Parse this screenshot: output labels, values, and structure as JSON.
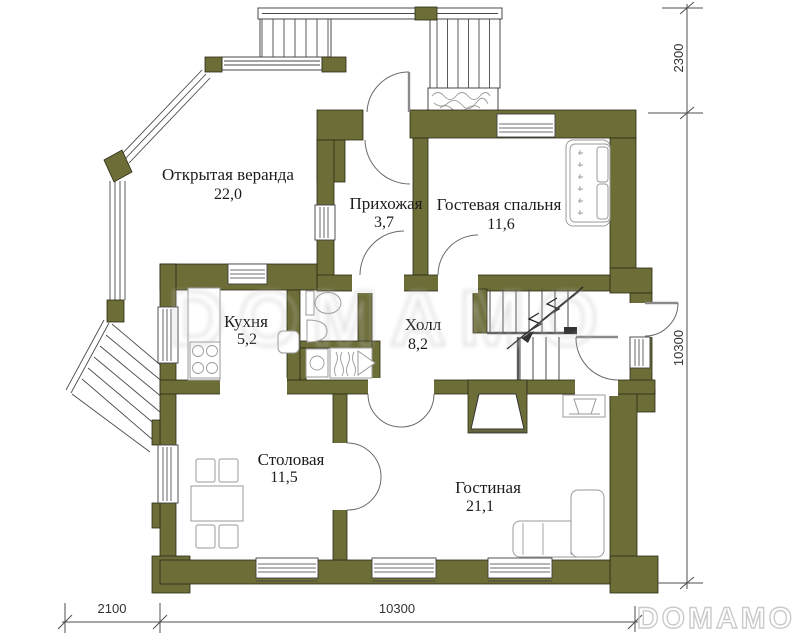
{
  "colors": {
    "wall": "#6d6d38",
    "outline": "#2b2b14",
    "furniture": "#9a9a9a",
    "watermark": "#bdbdbd"
  },
  "rooms": [
    {
      "name": "Открытая веранда",
      "area": "22,0"
    },
    {
      "name": "Прихожая",
      "area": "3,7"
    },
    {
      "name": "Гостевая спальня",
      "area": "11,6"
    },
    {
      "name": "Кухня",
      "area": "5,2"
    },
    {
      "name": "Холл",
      "area": "8,2"
    },
    {
      "name": "Столовая",
      "area": "11,5"
    },
    {
      "name": "Гостиная",
      "area": "21,1"
    }
  ],
  "dimensions": {
    "porch_depth": "2300",
    "house_side_right": "10300",
    "stair_width_bottom": "2100",
    "house_side_bottom": "10300"
  },
  "watermark": {
    "center": "DOMAMO",
    "corner": "DOMAMO"
  }
}
